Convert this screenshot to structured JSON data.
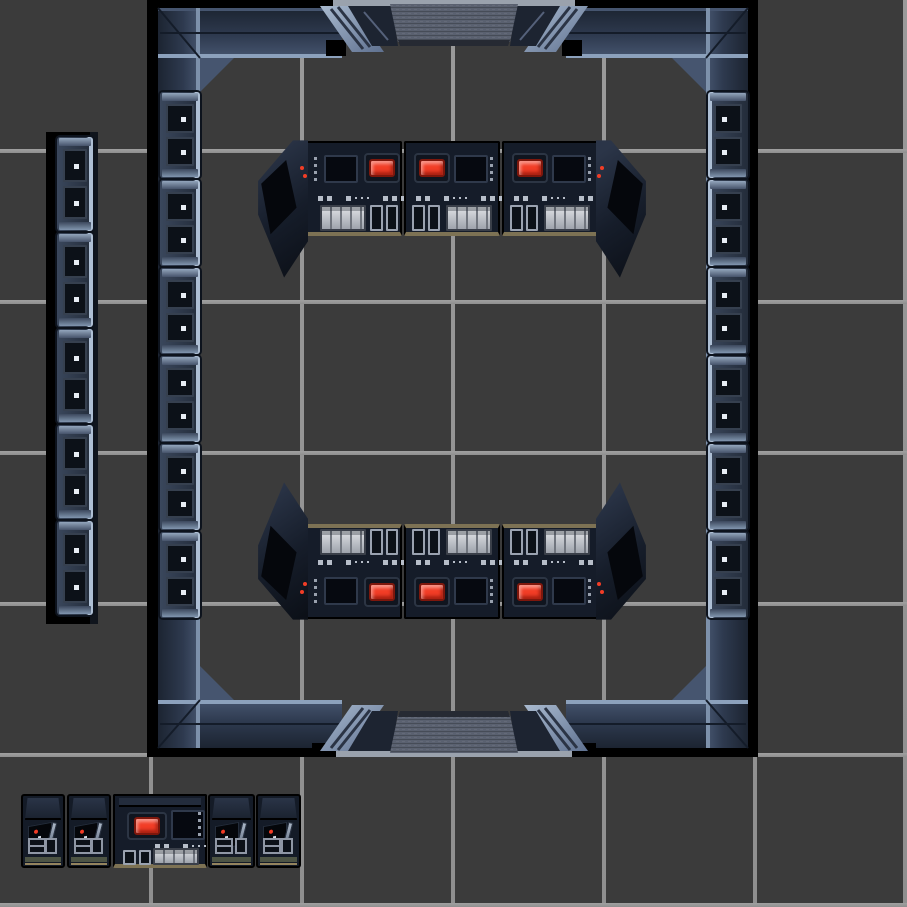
{
  "scene": {
    "title": "sci-fi starship room tilemap, top-down view",
    "width": 907,
    "height": 907
  },
  "palette": {
    "bg": "#3b3b3b",
    "grid": "#8f8f8f",
    "backdrop": "#000000",
    "beam_dark": "#1c2431",
    "beam_mid": "#2e3a4f",
    "beam_light": "#46556f",
    "beam_edge": "#8ca1bc",
    "seam": "#141c29",
    "door_slab": "#5a6170",
    "door_slab_shadow": "#262a33",
    "door_post": "#1d2431",
    "brace_hi": "#a9bacf",
    "brace_lo": "#5f7190",
    "brace_stripe": "#2b3445",
    "door_strip": "#9aa2ad",
    "console_body": "#151c29",
    "console_line": "#2f394b",
    "screen": "#060910",
    "red": "#f23d26",
    "red_dark": "#7e170c",
    "key_hi": "#dfe1e5",
    "key_lo": "#9ea3ac",
    "ind": "#b7bec9",
    "tan": "#7d7254",
    "olive": "#4d5444",
    "base_tan": "#94845e",
    "led": "#e8edf4",
    "cell": "#0c1118",
    "panel_hi": "#3a475c",
    "panel_lo": "#232c3a",
    "panel_edge": "#aebfd4"
  },
  "grid": {
    "tile_size": 151,
    "line_thickness": 4,
    "x_lines": [
      149,
      300,
      451,
      602,
      753,
      903
    ],
    "y_lines": [
      149,
      300,
      451,
      602,
      753,
      903
    ]
  },
  "shadows": [
    {
      "x": 147,
      "y": 0,
      "w": 11,
      "h": 757
    },
    {
      "x": 748,
      "y": 0,
      "w": 10,
      "h": 757
    },
    {
      "x": 147,
      "y": 0,
      "w": 611,
      "h": 9
    },
    {
      "x": 147,
      "y": 748,
      "w": 611,
      "h": 9
    },
    {
      "x": 46,
      "y": 132,
      "w": 52,
      "h": 492
    },
    {
      "x": 90,
      "y": 132,
      "w": 8,
      "h": 492,
      "color": "#10151d"
    }
  ],
  "room": {
    "bounds": {
      "x": 147,
      "y": 0,
      "w": 611,
      "h": 757
    },
    "doors": [
      {
        "side": "top"
      },
      {
        "side": "bottom"
      }
    ]
  },
  "wall_panels": {
    "outer_strip": {
      "x": 57,
      "y": 137,
      "module_w": 36,
      "module_h": 96,
      "count": 5,
      "side": "left"
    },
    "left_wall": {
      "x": 160,
      "y": 92,
      "module_w": 40,
      "module_h": 88,
      "count": 6,
      "side": "left"
    },
    "right_wall": {
      "x": 708,
      "y": 92,
      "module_w": 40,
      "module_h": 88,
      "count": 6,
      "side": "right"
    }
  },
  "console_banks": {
    "top": {
      "y": 141,
      "unit_h": 95,
      "facing": "down",
      "units": [
        {
          "x": 306,
          "w": 96,
          "variant": "screen-red"
        },
        {
          "x": 404,
          "w": 96,
          "variant": "red-screen"
        },
        {
          "x": 502,
          "w": 96,
          "variant": "red-screen"
        }
      ],
      "wedges": [
        {
          "x": 256,
          "y": 139,
          "pos": "tl"
        },
        {
          "x": 596,
          "y": 139,
          "pos": "tr"
        }
      ]
    },
    "bottom": {
      "y": 524,
      "unit_h": 95,
      "facing": "up",
      "units": [
        {
          "x": 306,
          "w": 96,
          "variant": "screen-red"
        },
        {
          "x": 404,
          "w": 96,
          "variant": "red-screen"
        },
        {
          "x": 502,
          "w": 96,
          "variant": "red-screen"
        }
      ],
      "wedges": [
        {
          "x": 256,
          "y": 481,
          "pos": "bl"
        },
        {
          "x": 596,
          "y": 481,
          "pos": "br"
        }
      ]
    },
    "detached_row": {
      "y": 794,
      "unit_h": 74,
      "units": [
        {
          "x": 21,
          "w": 44,
          "type": "cabinet"
        },
        {
          "x": 67,
          "w": 44,
          "type": "cabinet"
        },
        {
          "x": 113,
          "w": 94,
          "type": "workstation"
        },
        {
          "x": 208,
          "w": 47,
          "type": "cabinet"
        },
        {
          "x": 256,
          "w": 45,
          "type": "cabinet"
        }
      ]
    }
  }
}
